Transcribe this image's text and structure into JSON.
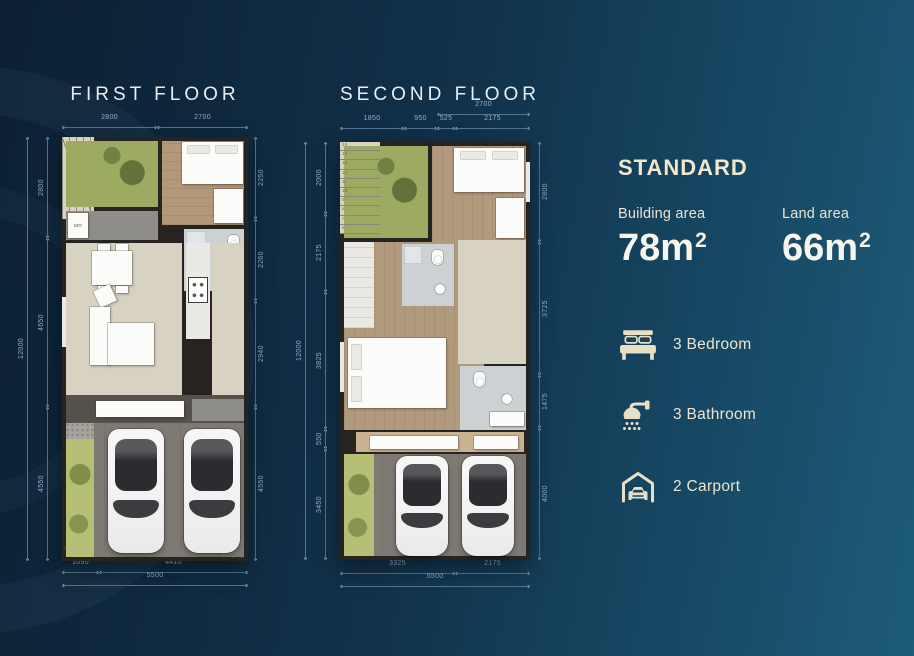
{
  "first_floor": {
    "title": "FIRST FLOOR",
    "room_label_mo": "MO",
    "stairs_up": "UP",
    "stairs_steps": "1 2 3",
    "dims": {
      "top": [
        "2800",
        "2700"
      ],
      "left_outer": "12000",
      "left": [
        "2800",
        "4650",
        "4550"
      ],
      "right": [
        "2250",
        "2260",
        "2940",
        "4550"
      ],
      "bottom": [
        "1090",
        "4410"
      ],
      "bottom_outer": "5500"
    }
  },
  "second_floor": {
    "title": "SECOND FLOOR",
    "stair_numbers": [
      "15",
      "14",
      "13",
      "12",
      "11",
      "10",
      "9",
      "8",
      "7",
      "6"
    ],
    "dims": {
      "top_outer": "2700",
      "top": [
        "1850",
        "950",
        "525",
        "2175"
      ],
      "left_outer": "12000",
      "left": [
        "2000",
        "2175",
        "3825",
        "550",
        "3450"
      ],
      "right": [
        "2800",
        "3725",
        "1475",
        "4000"
      ],
      "bottom": [
        "3325",
        "2175"
      ],
      "bottom_outer": "5500"
    }
  },
  "info_panel": {
    "plan_type": "STANDARD",
    "building_area": {
      "label": "Building area",
      "value": "78",
      "unit": "m",
      "sup": "2"
    },
    "land_area": {
      "label": "Land area",
      "value": "66",
      "unit": "m",
      "sup": "2"
    },
    "features": [
      {
        "icon": "bed-icon",
        "label": "3 Bedroom"
      },
      {
        "icon": "shower-icon",
        "label": "3 Bathroom"
      },
      {
        "icon": "garage-icon",
        "label": "2 Carport"
      }
    ]
  },
  "colors": {
    "background_left": "#0c2033",
    "background_right": "#1d5b78",
    "accent_cream": "#f1e7cb",
    "dimension_text": "#93adc6",
    "wall": "#272320",
    "garden_green": "#9dab62",
    "wood_floor": "#b29778",
    "title_text": "#e8edf1"
  }
}
